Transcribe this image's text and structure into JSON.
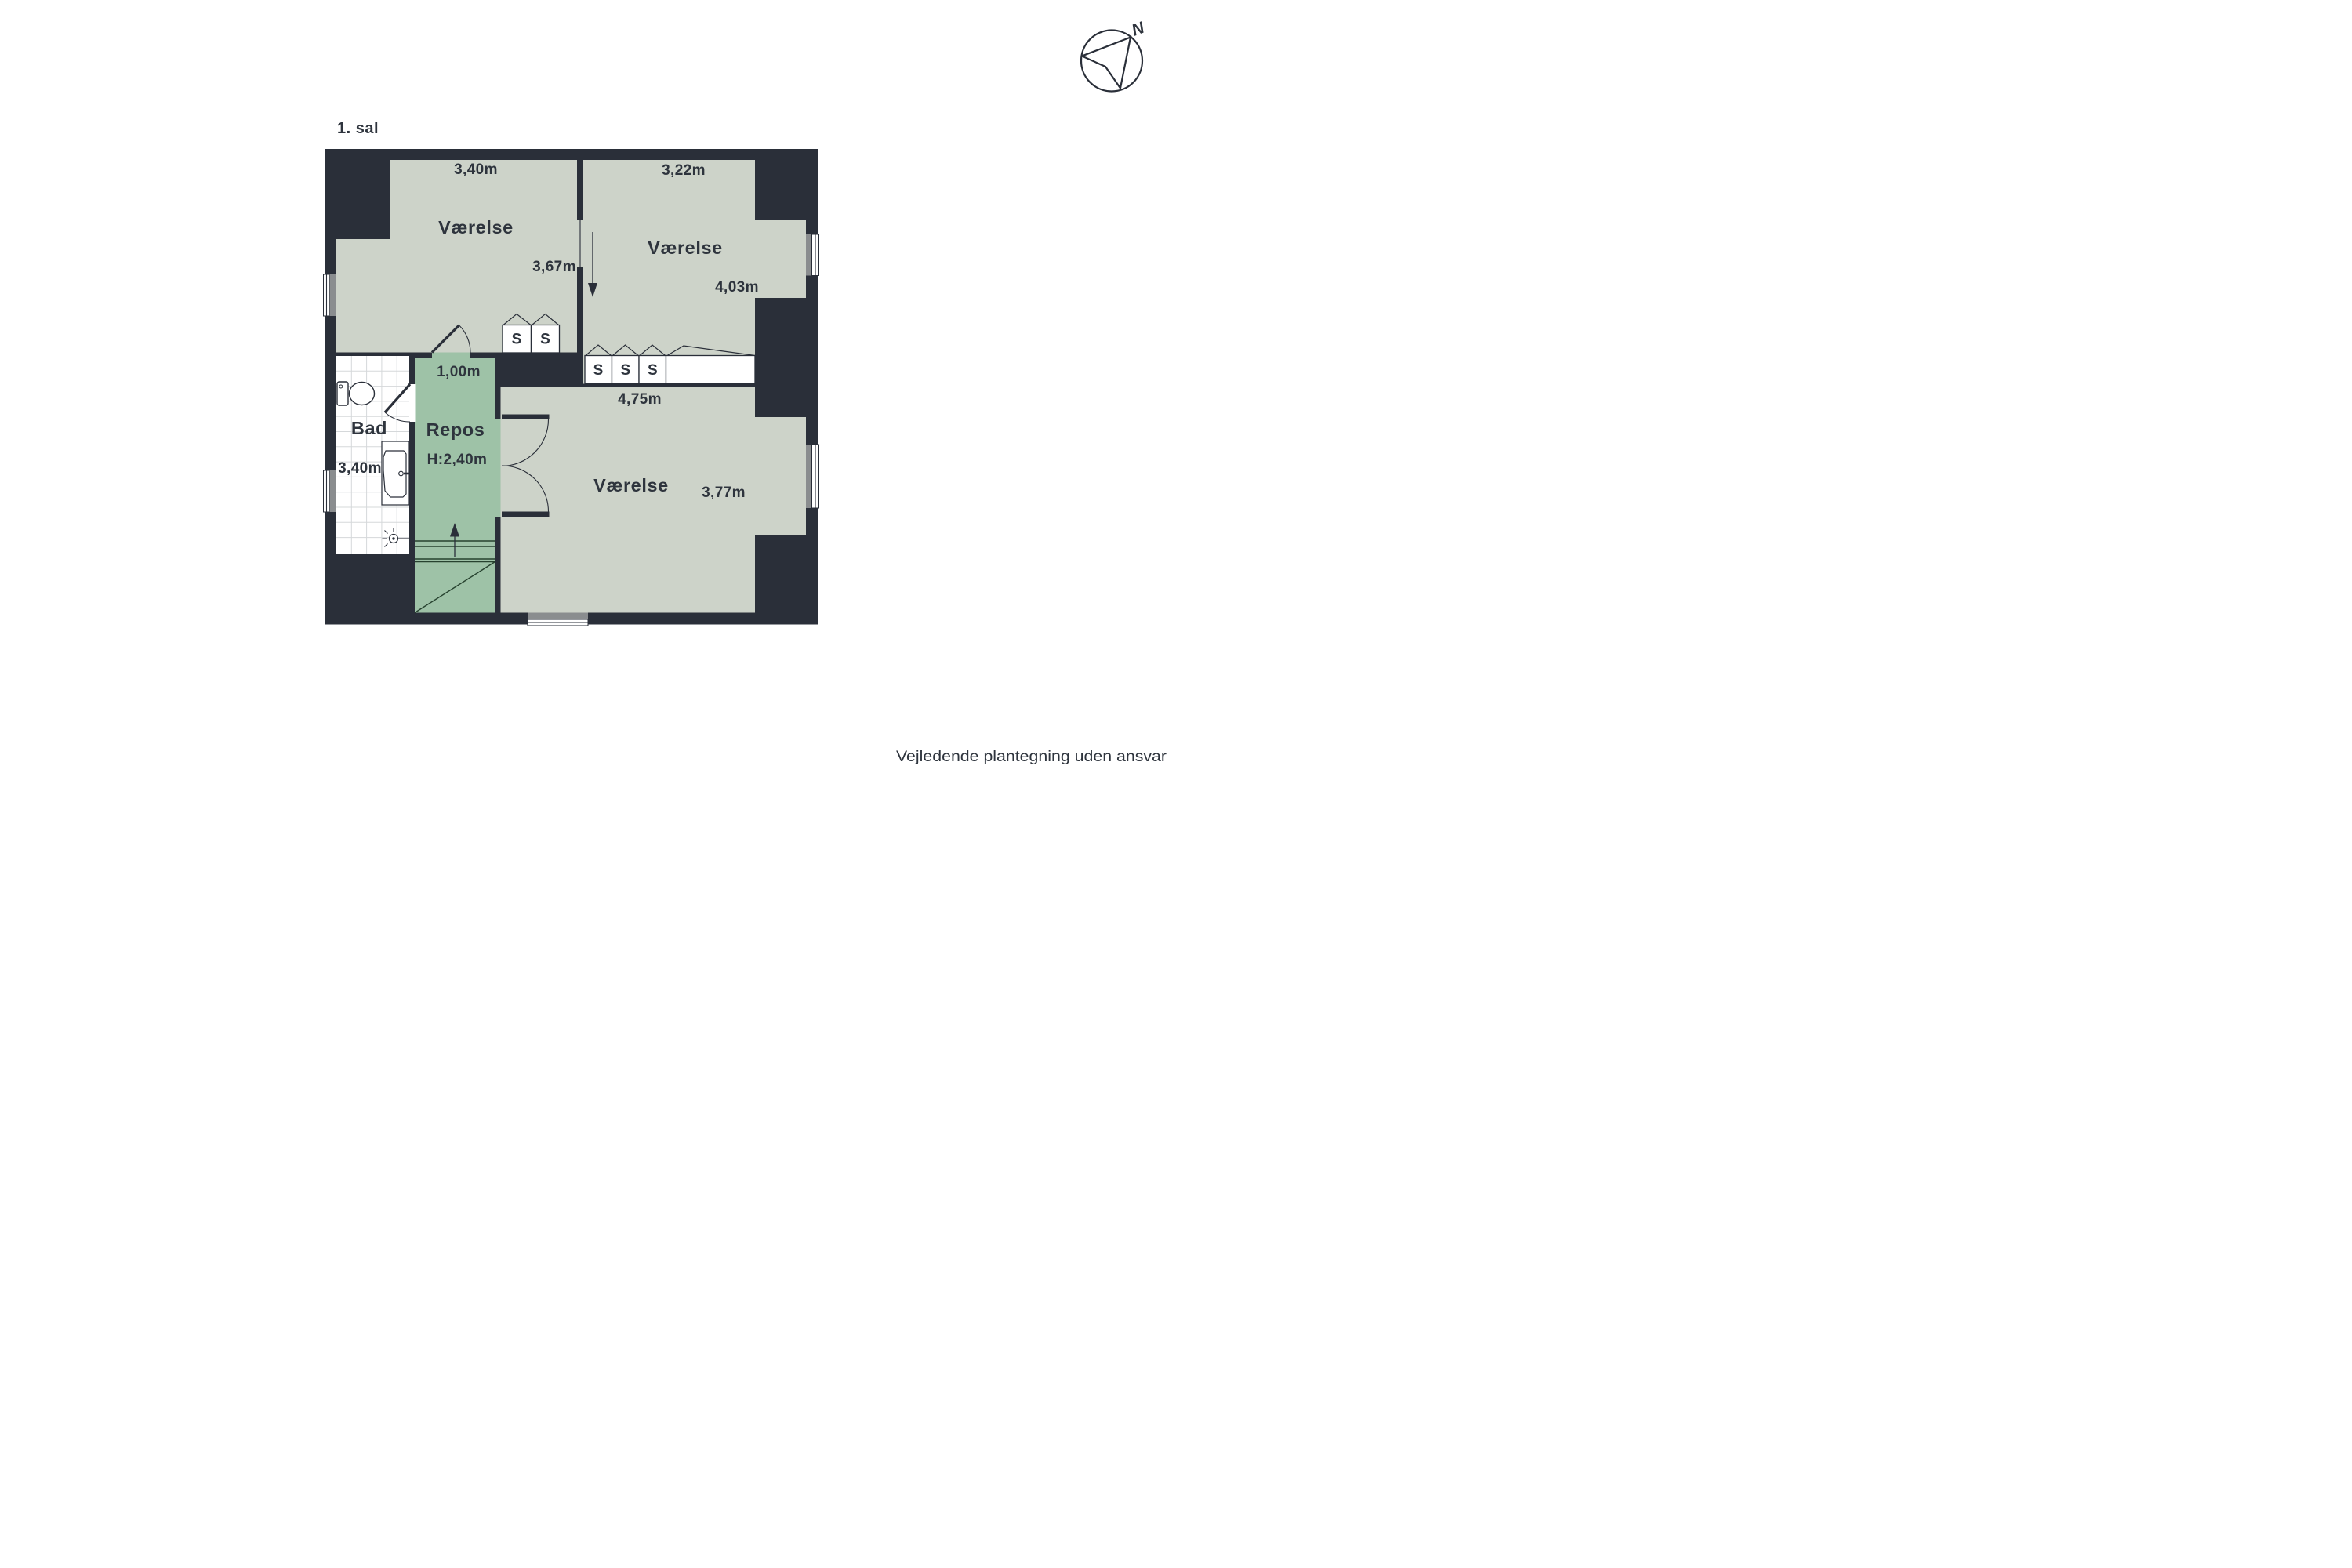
{
  "floor_plan": {
    "level_label": "1. sal",
    "rooms": [
      {
        "id": "vaerelse-nw",
        "name": "Værelse",
        "width_label": "3,40m",
        "depth_label": "3,67m"
      },
      {
        "id": "vaerelse-ne",
        "name": "Værelse",
        "width_label": "3,22m",
        "depth_label": "4,03m"
      },
      {
        "id": "bad",
        "name": "Bad",
        "width_label": "3,40m"
      },
      {
        "id": "repos",
        "name": "Repos",
        "width_label": "1,00m",
        "ceiling_height_label": "H:2,40m"
      },
      {
        "id": "vaerelse-s",
        "name": "Værelse",
        "width_label": "4,75m",
        "depth_label": "3,77m"
      }
    ],
    "closet_label": "S",
    "compass_north_label": "N",
    "disclaimer": "Vejledende plantegning uden ansvar",
    "colors": {
      "wall": "#2a2f39",
      "room_fill": "#cdd3c9",
      "repos_fill": "#9ec2a7",
      "window_gray": "#8a8d8f",
      "stair_lines": "#27422f",
      "text": "#2e343d",
      "background": "#ffffff"
    }
  }
}
